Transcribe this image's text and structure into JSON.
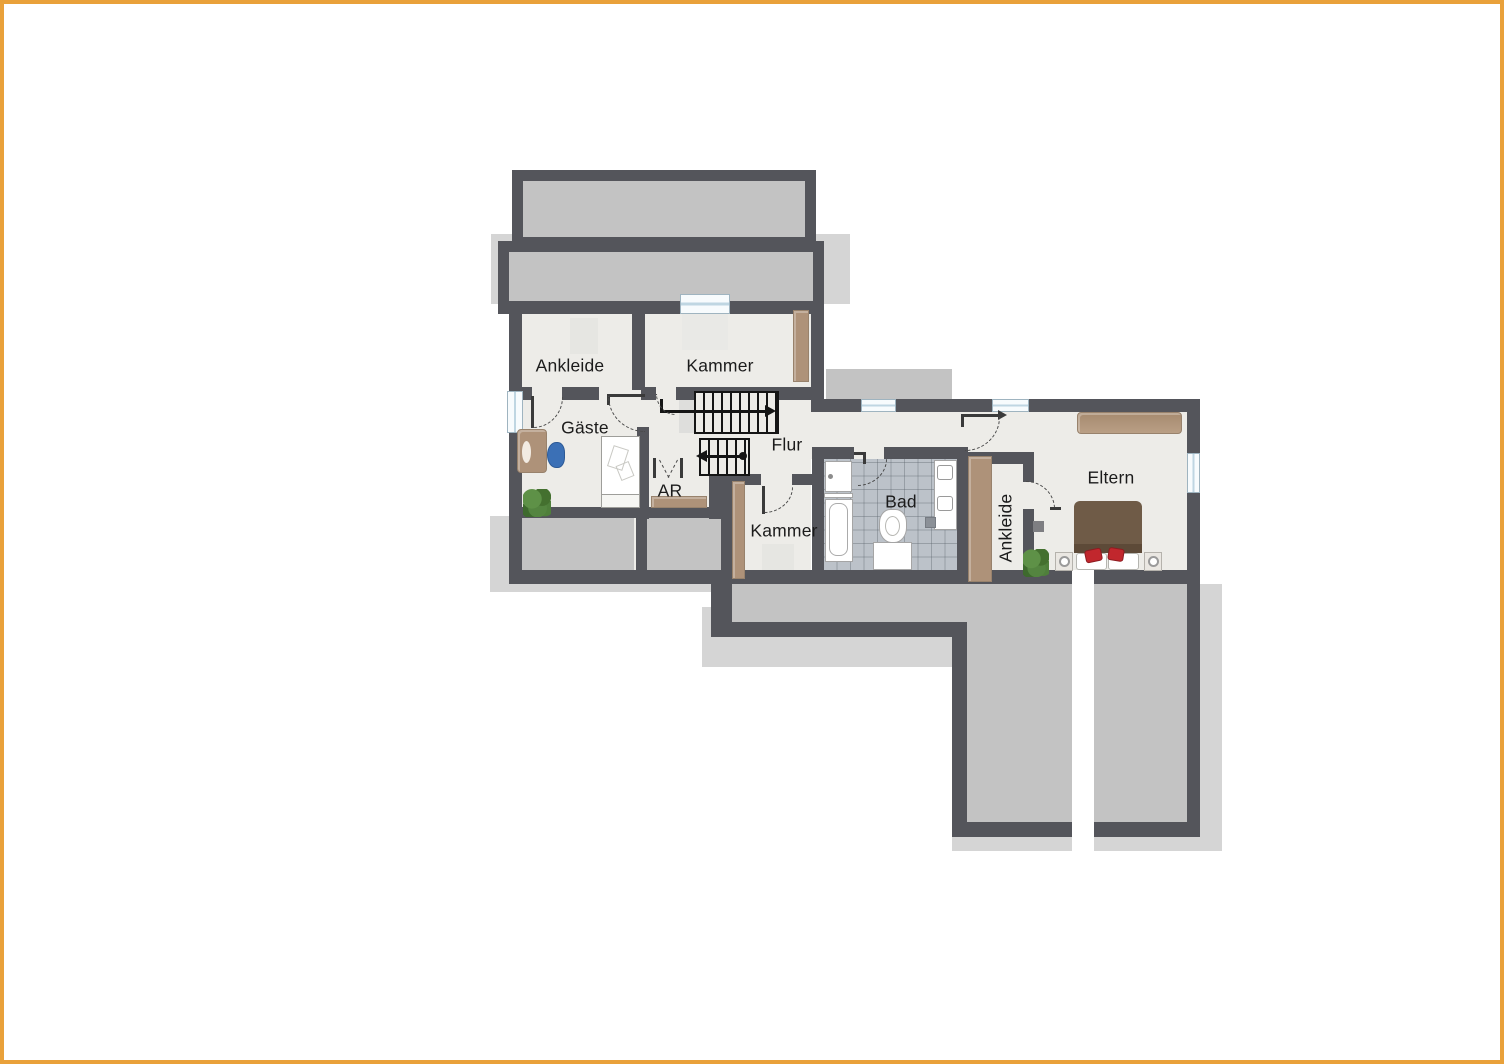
{
  "page": {
    "background": "#FFFFFF",
    "border_color": "#E9A13A",
    "content_type": "floor-plan, upper storey (Dachgeschoss), German labels"
  },
  "palette": {
    "wall": "#54555B",
    "floor": "#EDECE8",
    "roof_gray": "#C3C3C3",
    "shadow_gray": "#D5D5D5",
    "wood_brown": "#AE9279",
    "bath_tile": "#BCC2C9",
    "stair_line": "#151515",
    "door_dash": "#4A4A4A",
    "window_fill": "#F7FBFD",
    "plant_green": "#4C7C38",
    "chair_blue": "#3B70B6",
    "cushion_red": "#C1272D",
    "bed_brown": "#6F5B47",
    "label_text": "#1B1B1B"
  },
  "rooms": {
    "ankleide_top": {
      "label": "Ankleide"
    },
    "kammer_top": {
      "label": "Kammer"
    },
    "gaeste": {
      "label": "Gäste"
    },
    "flur": {
      "label": "Flur"
    },
    "abstellraum": {
      "label": "AR"
    },
    "kammer_unten": {
      "label": "Kammer"
    },
    "bad": {
      "label": "Bad"
    },
    "ankleide_eltern": {
      "label": "Ankleide"
    },
    "eltern": {
      "label": "Eltern"
    }
  },
  "stairs": {
    "upper_flight_steps": 9,
    "lower_flight_steps": 5,
    "upper_arrow_direction": "right",
    "lower_arrow_direction": "left"
  },
  "counts": {
    "windows": 5,
    "door_swings": 8
  },
  "furniture": [
    "desk",
    "office-chair",
    "plant",
    "single-bed",
    "storage-shelf",
    "wardrobe-kammer",
    "wardrobe-kammer-unten",
    "wardrobe-ankleide",
    "wardrobe-eltern",
    "washbasin",
    "bathtub",
    "toilet",
    "double-washbasin-vanity",
    "double-bed",
    "pillows",
    "red-cushions",
    "nightstand-left",
    "nightstand-right",
    "bedside-lamps",
    "plant-eltern"
  ]
}
